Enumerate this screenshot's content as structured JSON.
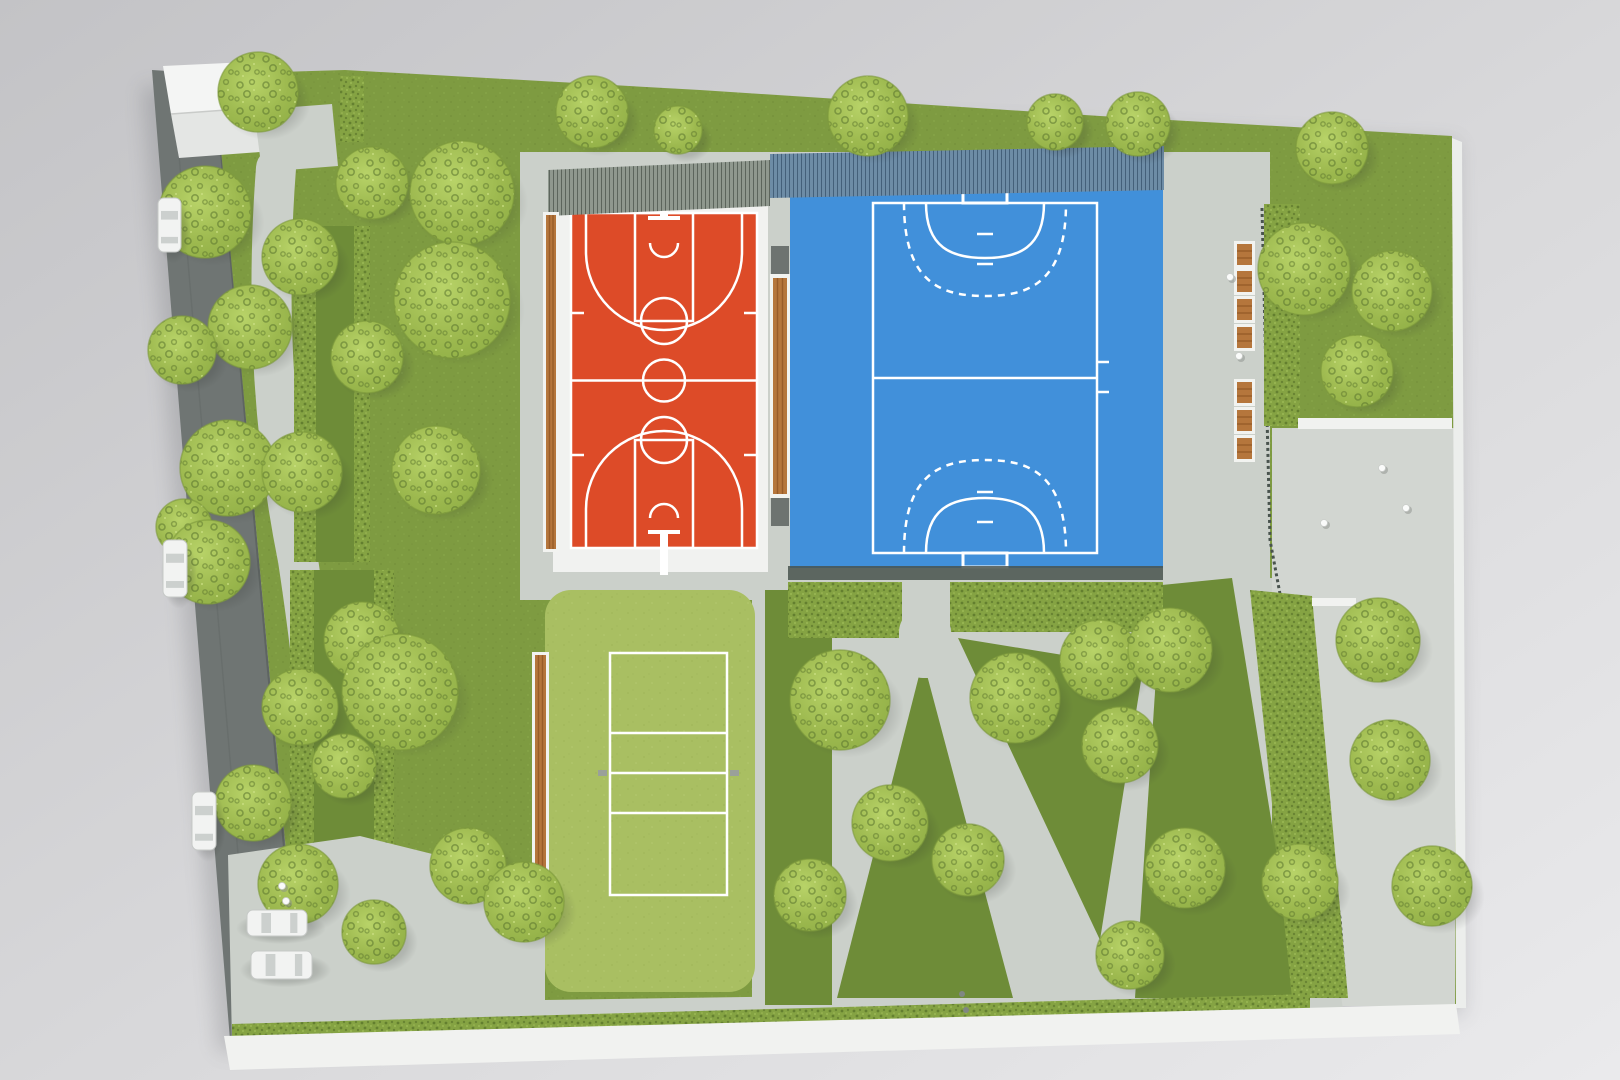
{
  "image": {
    "title": "Top-down photograph of an architectural scale model of a public sports park",
    "media": "physical maquette, foam trees and felt grass, studio backdrop",
    "visible_text": "none"
  },
  "palette": {
    "backdrop_light": "#eaeaec",
    "backdrop_dark": "#c3c3c6",
    "road_gray": "#6f7573",
    "road_edge": "#585e5c",
    "board_gray": "#cbd0ca",
    "plaza_gray": "#d2d6d1",
    "base_white": "#f1f2f0",
    "grass_green": "#7e9b41",
    "grass_dark": "#6e8c38",
    "pad_green": "#a9bf62",
    "hedge_green": "#85a343",
    "hedge_dark": "#46601f",
    "hedge_light": "#a8c45e",
    "tree_light": "#b8d368",
    "tree_mid": "#9db94f",
    "tree_edge": "#8fae45",
    "tree_hole": "#5c772e",
    "court_red": "#dd4b28",
    "court_blue": "#4190da",
    "line_white": "#ffffff",
    "bench_wood": "#b5763c",
    "bench_slat": "#985c29",
    "frame_white": "#f2f3f0",
    "fence_gray": "#8f988e",
    "fence_gray_line": "#5c655c",
    "fence_blue": "#6d8ca6",
    "fence_blue_line": "#44607a",
    "fence_dark": "#49534e",
    "car_white": "#f2f3f2",
    "car_glass": "#ccd0ce"
  },
  "scene": {
    "courts": [
      {
        "id": "basketball",
        "sport": "basketball",
        "surface_color": "#dd4b28",
        "line_color": "#ffffff",
        "features": [
          "halfway line",
          "center circle",
          "two keys with free-throw circles",
          "no-charge semicircles",
          "three-point arcs",
          "sideline ticks",
          "two hoop posts with backboards"
        ]
      },
      {
        "id": "handball",
        "sport": "handball / futsal",
        "surface_color": "#4190da",
        "line_color": "#ffffff",
        "features": [
          "halfway line",
          "solid 6 m goal-area arcs",
          "dashed 9 m free-throw arcs",
          "penalty marks",
          "two goals",
          "substitution ticks on right sideline"
        ]
      },
      {
        "id": "volleyball",
        "sport": "volleyball",
        "surface_color": "#a9bf62",
        "line_color": "#ffffff",
        "features": [
          "outer boundary",
          "center line",
          "two attack lines",
          "net posts"
        ]
      }
    ],
    "site": {
      "road": "dark grey street running down the left edge of the model",
      "parking": "light grey lot at bottom left with parked white model cars",
      "paths": "light grey footpaths winding between lawns",
      "plaza": "light grey paved areas along the right side",
      "fences": "mesh fence strips above the courts and a thin dark fence on the right",
      "building": "small white block with ridged roof in the top-left corner",
      "background": "plain grey studio backdrop"
    },
    "vegetation": {
      "tree_style": "open-cell foam balls, yellow-green",
      "hedge_style": "dense textured foam strips",
      "lawn_style": "green felt",
      "tree_count": 46
    },
    "trees": [
      {
        "x": 258,
        "y": 92,
        "r": 40
      },
      {
        "x": 592,
        "y": 112,
        "r": 36
      },
      {
        "x": 678,
        "y": 130,
        "r": 24
      },
      {
        "x": 868,
        "y": 116,
        "r": 40
      },
      {
        "x": 1055,
        "y": 122,
        "r": 28
      },
      {
        "x": 1138,
        "y": 124,
        "r": 32
      },
      {
        "x": 1332,
        "y": 148,
        "r": 36
      },
      {
        "x": 205,
        "y": 212,
        "r": 46
      },
      {
        "x": 372,
        "y": 183,
        "r": 36
      },
      {
        "x": 462,
        "y": 193,
        "r": 52
      },
      {
        "x": 300,
        "y": 257,
        "r": 38
      },
      {
        "x": 250,
        "y": 327,
        "r": 42
      },
      {
        "x": 182,
        "y": 350,
        "r": 34
      },
      {
        "x": 452,
        "y": 300,
        "r": 58
      },
      {
        "x": 367,
        "y": 357,
        "r": 36
      },
      {
        "x": 228,
        "y": 468,
        "r": 48
      },
      {
        "x": 302,
        "y": 472,
        "r": 40
      },
      {
        "x": 436,
        "y": 470,
        "r": 44
      },
      {
        "x": 184,
        "y": 527,
        "r": 28
      },
      {
        "x": 208,
        "y": 562,
        "r": 42
      },
      {
        "x": 362,
        "y": 640,
        "r": 38
      },
      {
        "x": 400,
        "y": 692,
        "r": 58
      },
      {
        "x": 300,
        "y": 707,
        "r": 38
      },
      {
        "x": 344,
        "y": 766,
        "r": 32
      },
      {
        "x": 253,
        "y": 803,
        "r": 38
      },
      {
        "x": 298,
        "y": 884,
        "r": 40
      },
      {
        "x": 374,
        "y": 932,
        "r": 32
      },
      {
        "x": 468,
        "y": 866,
        "r": 38
      },
      {
        "x": 524,
        "y": 902,
        "r": 40
      },
      {
        "x": 840,
        "y": 700,
        "r": 50
      },
      {
        "x": 810,
        "y": 895,
        "r": 36
      },
      {
        "x": 1015,
        "y": 698,
        "r": 45
      },
      {
        "x": 890,
        "y": 823,
        "r": 38
      },
      {
        "x": 968,
        "y": 860,
        "r": 36
      },
      {
        "x": 1100,
        "y": 660,
        "r": 40
      },
      {
        "x": 1170,
        "y": 650,
        "r": 42
      },
      {
        "x": 1120,
        "y": 745,
        "r": 38
      },
      {
        "x": 1185,
        "y": 868,
        "r": 40
      },
      {
        "x": 1130,
        "y": 955,
        "r": 34
      },
      {
        "x": 1304,
        "y": 269,
        "r": 46
      },
      {
        "x": 1392,
        "y": 291,
        "r": 40
      },
      {
        "x": 1357,
        "y": 371,
        "r": 36
      },
      {
        "x": 1378,
        "y": 640,
        "r": 42
      },
      {
        "x": 1390,
        "y": 760,
        "r": 40
      },
      {
        "x": 1300,
        "y": 882,
        "r": 38
      },
      {
        "x": 1432,
        "y": 886,
        "r": 40
      }
    ],
    "benches": {
      "style": "wood slats in white frames",
      "walkway_x": 1234,
      "walkway_bench_ys": [
        243,
        270,
        298,
        326,
        381,
        409,
        437
      ],
      "long_benches": [
        {
          "id": "left-of-basketball",
          "x": 543,
          "y": 212,
          "w": 16,
          "h": 340
        },
        {
          "id": "between-courts",
          "x": 770,
          "y": 274,
          "w": 20,
          "h": 224
        },
        {
          "id": "left-of-volleyball",
          "x": 532,
          "y": 652,
          "w": 17,
          "h": 238
        }
      ]
    },
    "cars": [
      {
        "x": 158,
        "y": 198,
        "w": 23,
        "h": 54,
        "o": "v"
      },
      {
        "x": 163,
        "y": 540,
        "w": 24,
        "h": 57,
        "o": "v"
      },
      {
        "x": 192,
        "y": 792,
        "w": 24,
        "h": 58,
        "o": "v"
      },
      {
        "x": 247,
        "y": 910,
        "w": 60,
        "h": 26,
        "o": "h"
      },
      {
        "x": 251,
        "y": 951,
        "w": 61,
        "h": 28,
        "o": "h"
      }
    ],
    "people": [
      [
        1230,
        277
      ],
      [
        1239,
        356
      ],
      [
        1382,
        468
      ],
      [
        1406,
        508
      ],
      [
        1324,
        523
      ],
      [
        282,
        886
      ],
      [
        286,
        901
      ]
    ],
    "bins": [
      [
        962,
        994
      ],
      [
        966,
        1010
      ]
    ]
  }
}
